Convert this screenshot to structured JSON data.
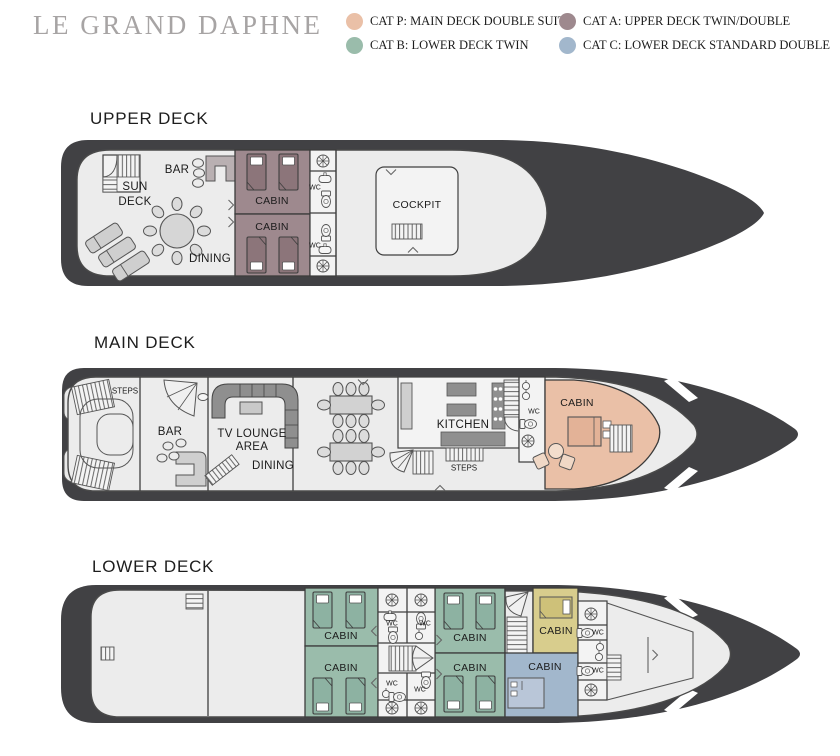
{
  "title": "LE GRAND DAPHNE",
  "legend": {
    "items": [
      {
        "id": "cat_p",
        "label": "CAT P: MAIN DECK DOUBLE SUITE",
        "color": "#eac0a7"
      },
      {
        "id": "cat_a",
        "label": "CAT A: UPPER DECK TWIN/DOUBLE",
        "color": "#9e898e"
      },
      {
        "id": "cat_b",
        "label": "CAT B: LOWER DECK TWIN",
        "color": "#9abcab"
      },
      {
        "id": "cat_c",
        "label": "CAT C: LOWER DECK STANDARD DOUBLE",
        "color": "#a2b7cc"
      }
    ]
  },
  "decks": {
    "upper": {
      "heading": "UPPER DECK"
    },
    "main": {
      "heading": "MAIN DECK"
    },
    "lower": {
      "heading": "LOWER DECK"
    }
  },
  "rooms": {
    "sun_deck": [
      "SUN",
      "DECK"
    ],
    "bar": "BAR",
    "dining": "DINING",
    "cabin": "CABIN",
    "wc": "WC",
    "cockpit": "COCKPIT",
    "steps": "STEPS",
    "tv_lounge": [
      "TV LOUNGE",
      "AREA"
    ],
    "kitchen": "KITCHEN"
  },
  "colors": {
    "hull": "#414144",
    "deck": "#ececec",
    "room": "#f3f3f3",
    "outline": "#4a4a4a",
    "furniture": "#d6d6d6",
    "dark_furniture": "#8f8f8f",
    "cat_p_dark": "#e3b297",
    "cat_a_dark": "#8c757a",
    "cat_b_dark": "#8db2a2",
    "crew_cabin": "#d8cd8d",
    "crew_cabin_dark": "#cec179",
    "cat_c_light": "#b9c6d8"
  }
}
